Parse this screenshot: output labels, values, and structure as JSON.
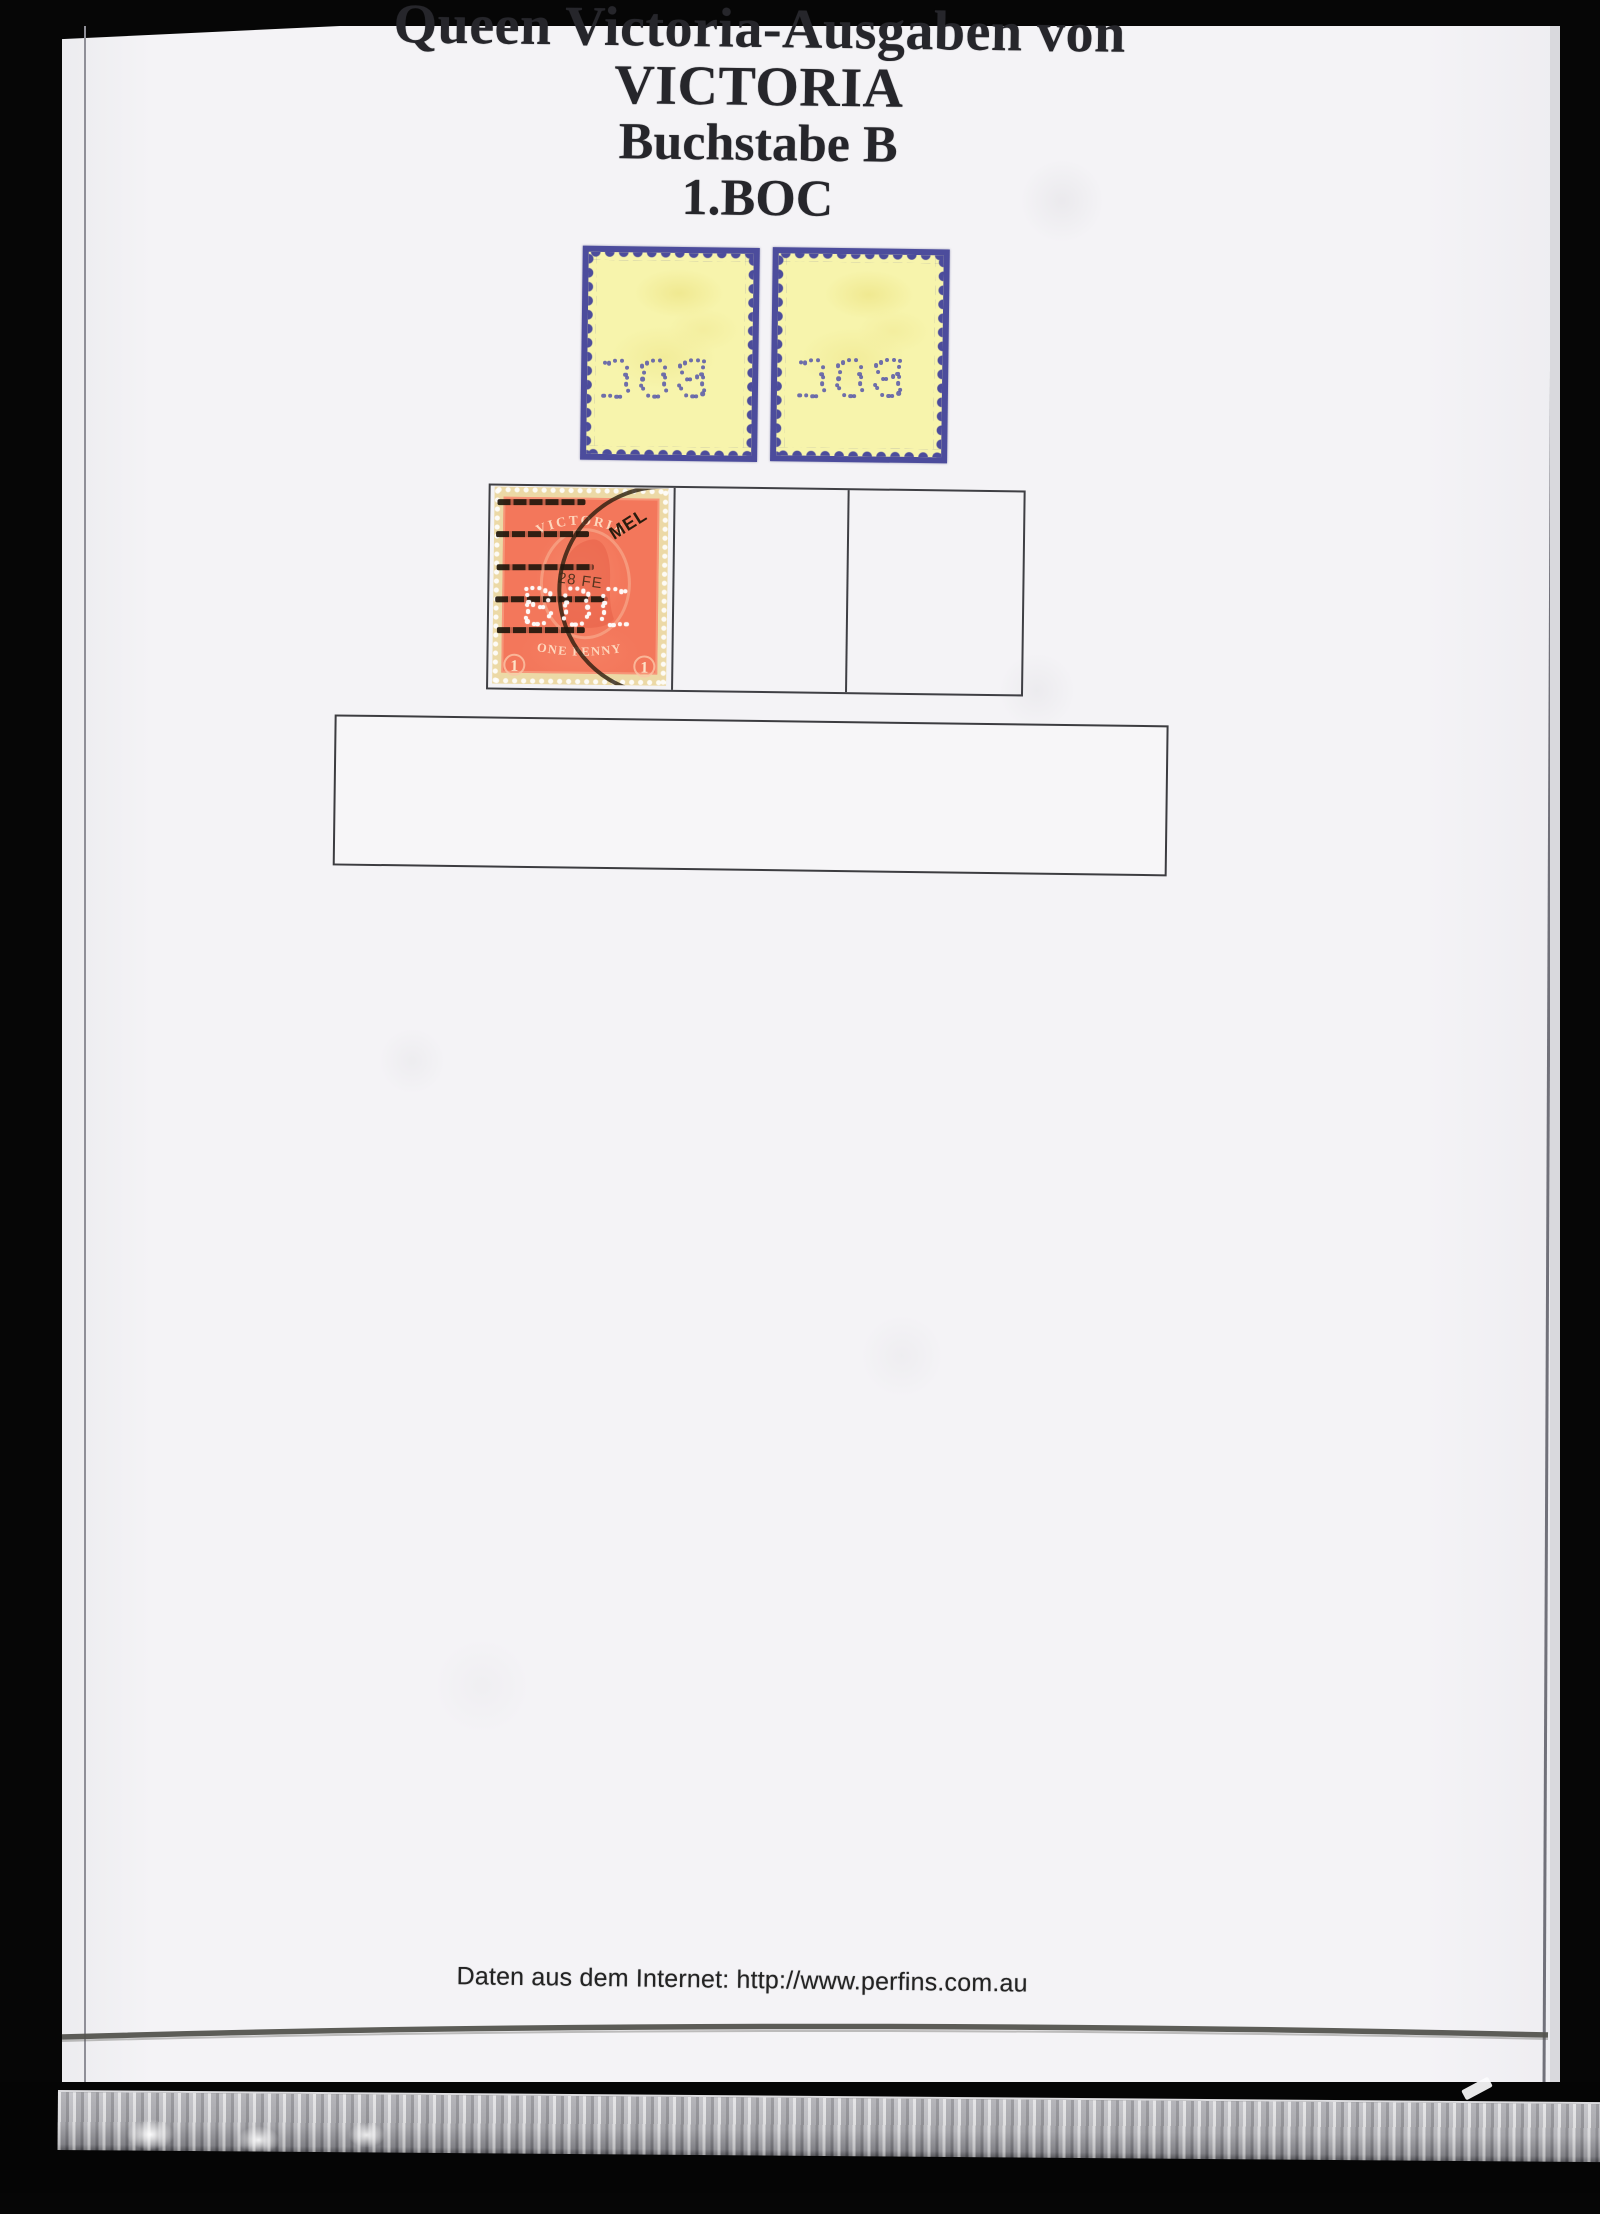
{
  "page": {
    "title_lines": {
      "l1": "Queen Victoria-Ausgaben von VICTORIA",
      "l2": "Buchstabe B",
      "l3": "1.BOC"
    },
    "footer_text": "Daten aus dem Internet: http://www.perfins.com.au"
  },
  "stamps": {
    "perfin_letters": "BOC",
    "orange": {
      "country_text": "VICTORIA",
      "denomination_text": "ONE PENNY",
      "corner_numeral": "1",
      "postmark_city": "MEL",
      "postmark_date": "28 FE"
    }
  },
  "colors": {
    "page_bg": "#f4f3f6",
    "frame_black": "#060606",
    "stamp_yellow": "#f7f4ac",
    "stamp_backing_blue": "#4c4c9c",
    "perfin_dot_blue": "#5b5baa",
    "stamp_orange": "#f3775b",
    "stamp_margin_buff": "#ecd9a6",
    "table_border": "#3f3f44",
    "postmark_ink": "#2f2315"
  }
}
